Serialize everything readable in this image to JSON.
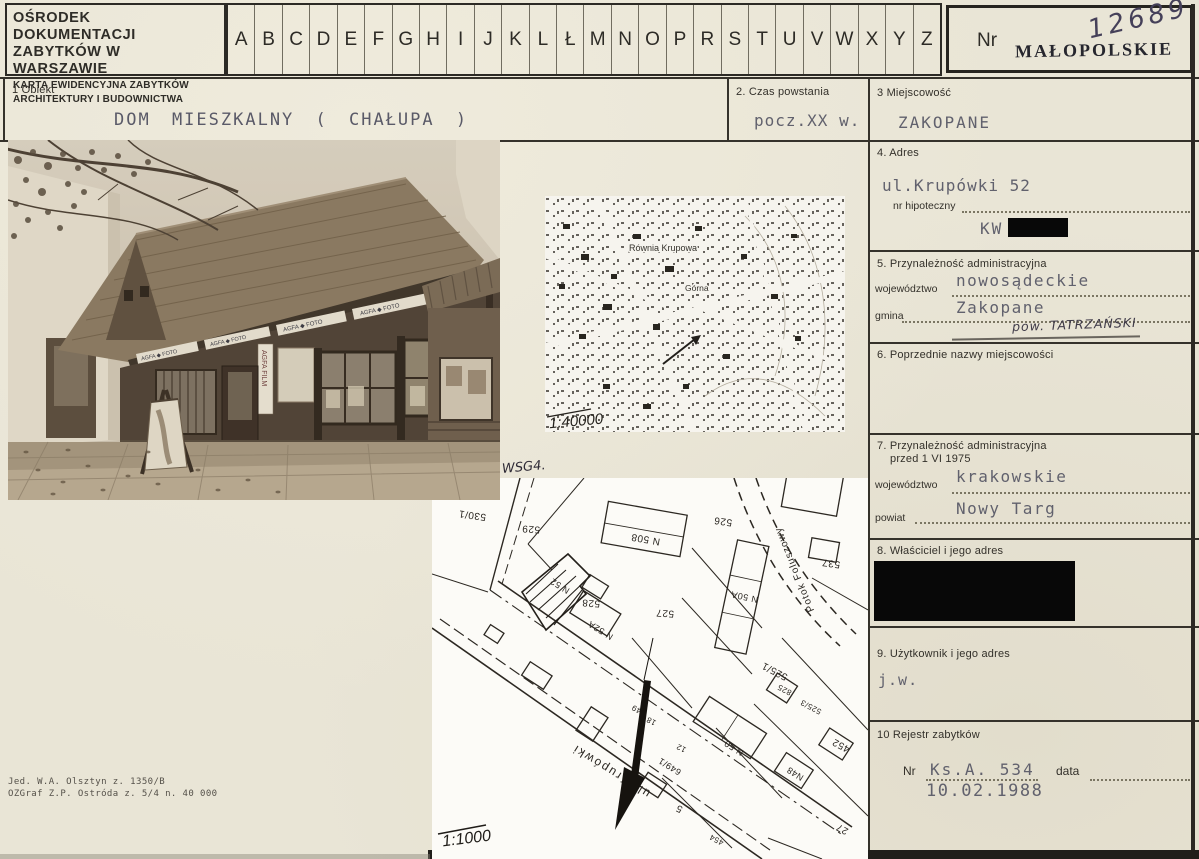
{
  "header": {
    "institution_line1": "OŚRODEK DOKUMENTACJI",
    "institution_line2": "ZABYTKÓW W WARSZAWIE",
    "institution_line3": "KARTA EWIDENCYJNA ZABYTKÓW",
    "institution_line4": "ARCHITEKTURY I BUDOWNICTWA",
    "alphabet": [
      "A",
      "B",
      "C",
      "D",
      "E",
      "F",
      "G",
      "H",
      "I",
      "J",
      "K",
      "L",
      "Ł",
      "M",
      "N",
      "O",
      "P",
      "R",
      "S",
      "T",
      "U",
      "V",
      "W",
      "X",
      "Y",
      "Z"
    ],
    "nr_label": "Nr",
    "voivodeship_stamp": "MAŁOPOLSKIE",
    "handwritten_number": "12689"
  },
  "fields": {
    "f1": {
      "label": "1  Obiekt",
      "value": "DOM  MIESZKALNY  ( CHAŁUPA )"
    },
    "f2": {
      "label": "2. Czas powstania",
      "value": "pocz.XX w."
    },
    "f3": {
      "label": "3  Miejscowość",
      "value": "ZAKOPANE"
    },
    "f4": {
      "label": "4. Adres",
      "value": "ul.Krupówki 52",
      "sub_label": "nr hipoteczny",
      "kw_label": "KW"
    },
    "f5": {
      "label": "5. Przynależność administracyjna",
      "wojewodztwo_label": "województwo",
      "wojewodztwo_value": "nowosądeckie",
      "gmina_label": "gmina",
      "gmina_value": "Zakopane",
      "handwritten": "pow. TATRZAŃSKI"
    },
    "f6": {
      "label": "6. Poprzednie nazwy miejscowości"
    },
    "f7": {
      "label": "7. Przynależność administracyjna",
      "label2": "przed 1 VI 1975",
      "wojewodztwo_label": "województwo",
      "wojewodztwo_value": "krakowskie",
      "powiat_label": "powiat",
      "powiat_value": "Nowy Targ"
    },
    "f8": {
      "label": "8. Właściciel i jego adres"
    },
    "f9": {
      "label": "9. Użytkownik i jego adres",
      "value": "j.w."
    },
    "f10": {
      "label": "10  Rejestr zabytków",
      "nr_label": "Nr",
      "nr_value": "Ks.A. 534",
      "data_label": "data",
      "date_value": "10.02.1988"
    }
  },
  "photo": {
    "sign_text": "AGFA ◆ FOTO",
    "banner_text": "AGFA FILM"
  },
  "maps": {
    "note": "WSG4.",
    "topo": {
      "scale": "1:40000",
      "labels": [
        "Równia Krupowa",
        "Górna"
      ]
    },
    "cadastral": {
      "scale": "1:1000",
      "street": "ul. Krupówki",
      "stream": "Potok Foluszowy",
      "parcels": [
        "530/1",
        "529",
        "528",
        "526",
        "527",
        "537",
        "525/1",
        "825",
        "525/3",
        "452",
        "27",
        "454",
        "5",
        "649/1",
        "649",
        "18",
        "12"
      ],
      "buildings": [
        "N 52",
        "N 52A",
        "N 508",
        "N 50A",
        "N 50",
        "N48"
      ]
    }
  },
  "footer": {
    "line1": "Jed. W.A. Olsztyn z. 1350/B",
    "line2": "OZGraf Z.P. Ostróda z. 5/4 n. 40 000"
  }
}
